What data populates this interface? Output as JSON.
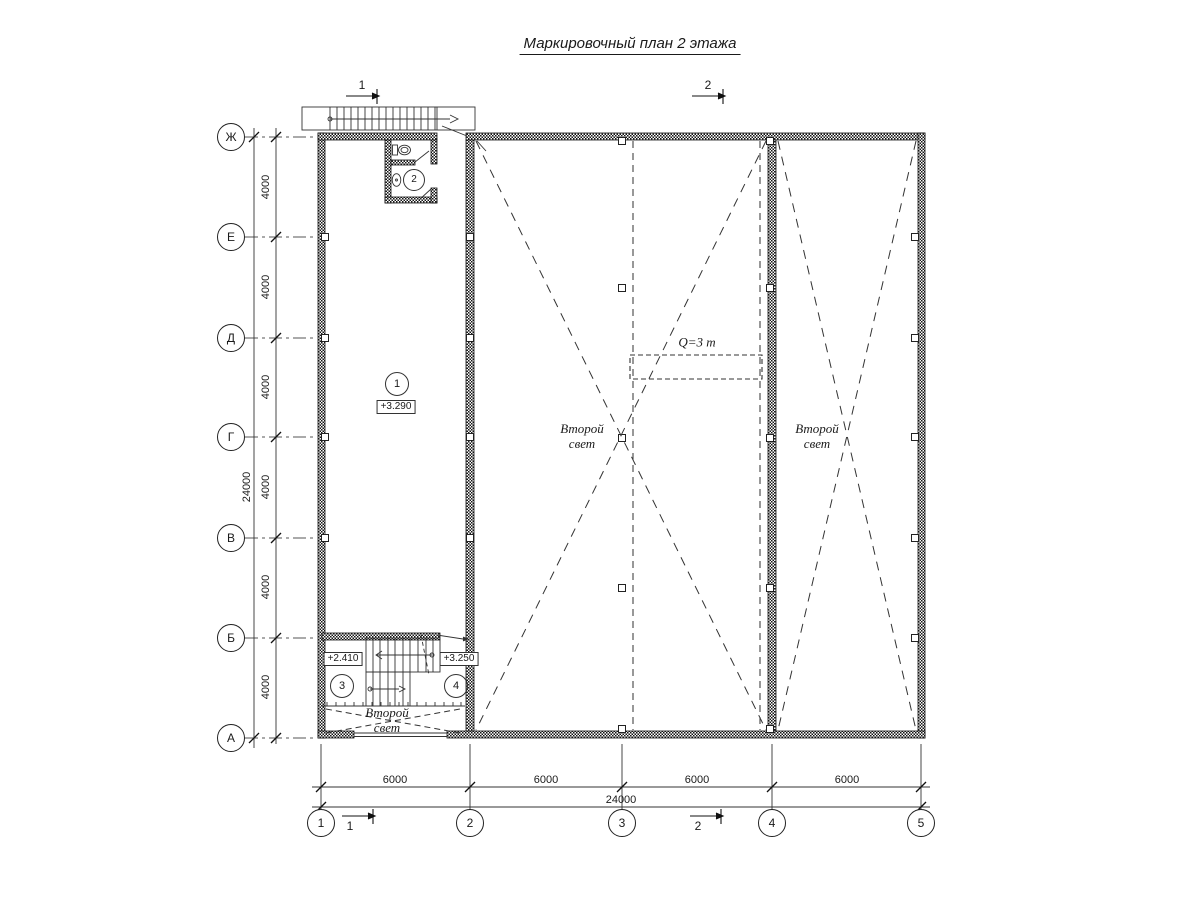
{
  "title": "Маркировочный план 2 этажа",
  "grid": {
    "rows": [
      {
        "label": "Ж"
      },
      {
        "label": "Е"
      },
      {
        "label": "Д"
      },
      {
        "label": "Г"
      },
      {
        "label": "В"
      },
      {
        "label": "Б"
      },
      {
        "label": "А"
      }
    ],
    "cols": [
      {
        "label": "1"
      },
      {
        "label": "2"
      },
      {
        "label": "3"
      },
      {
        "label": "4"
      },
      {
        "label": "5"
      }
    ]
  },
  "dims": {
    "left": [
      "4000",
      "4000",
      "4000",
      "4000",
      "4000",
      "4000"
    ],
    "left_total": "24000",
    "bottom": [
      "6000",
      "6000",
      "6000",
      "6000"
    ],
    "bottom_total": "24000"
  },
  "rooms": {
    "r1": {
      "num": "1",
      "elev": "+3.290"
    },
    "r2": {
      "num": "2"
    },
    "r3": {
      "num": "3",
      "elev": "+2.410"
    },
    "r4": {
      "num": "4",
      "elev": "+3.250"
    }
  },
  "labels": {
    "second_light": {
      "line1": "Второй",
      "line2": "свет"
    },
    "crane": "Q=3 т"
  },
  "marks": {
    "m1": "1",
    "m2": "2"
  },
  "colors": {
    "line": "#1a1a1a",
    "background": "#ffffff"
  }
}
